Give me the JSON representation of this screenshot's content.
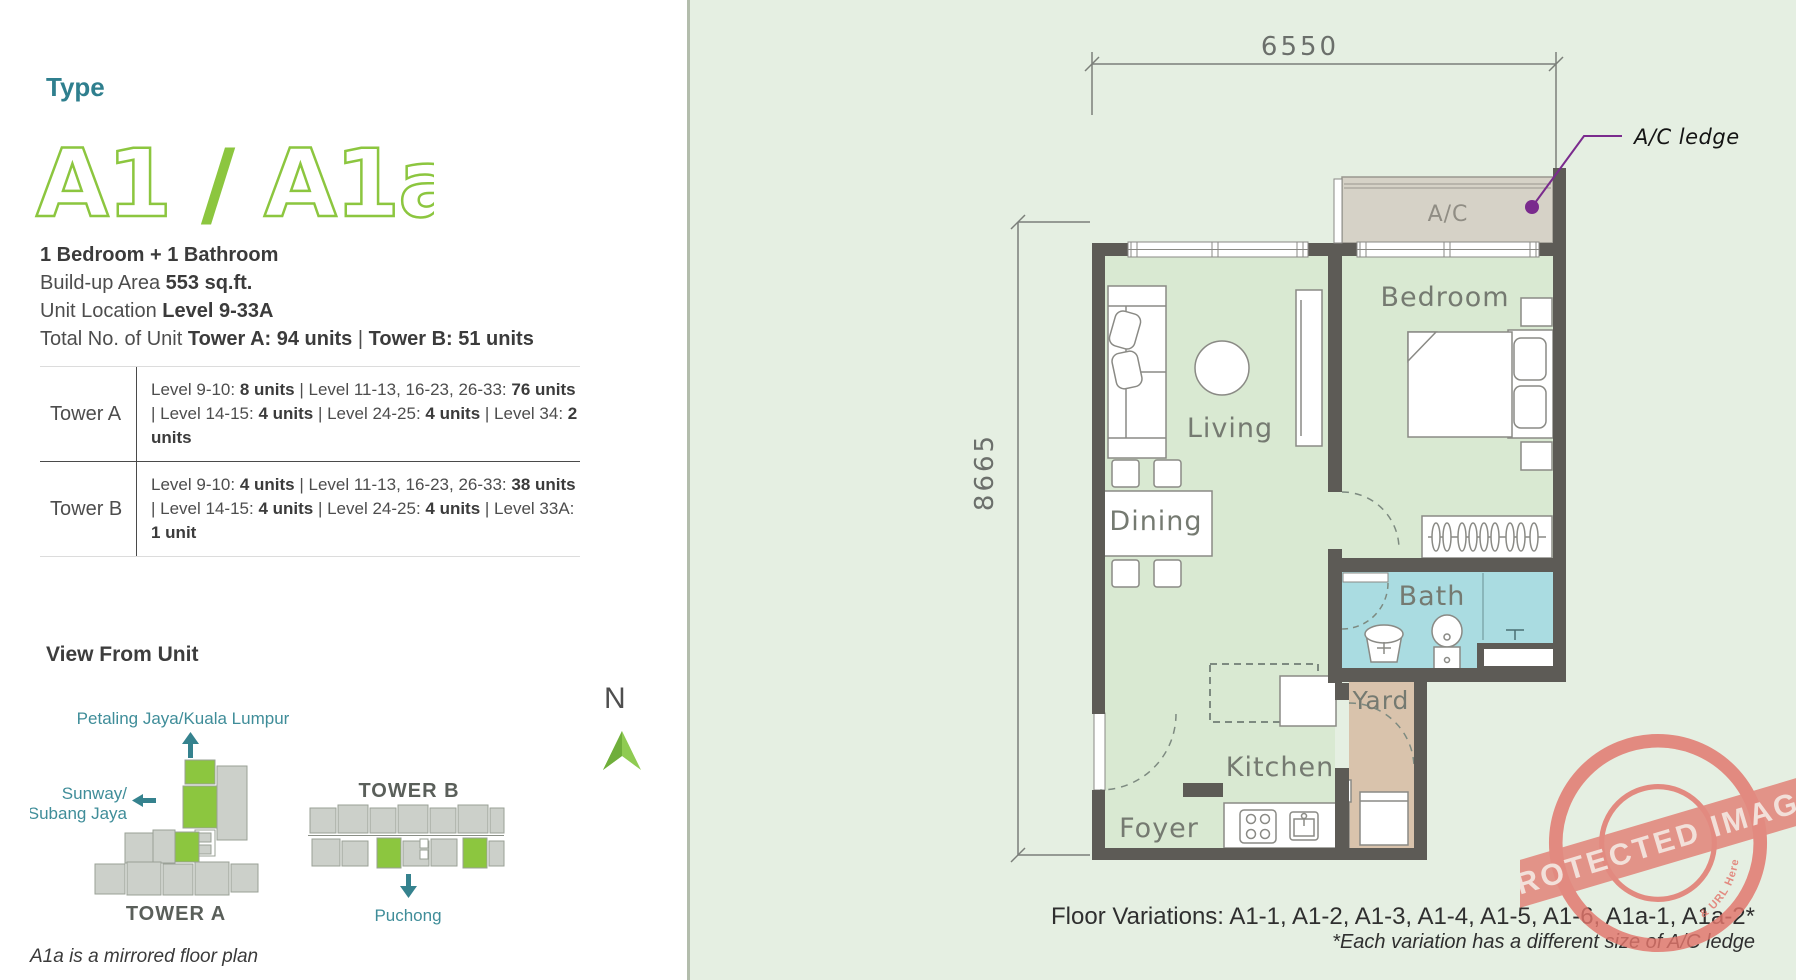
{
  "colors": {
    "accent_teal": "#2f7f8e",
    "brand_green": "#8cc63f",
    "wall_gray": "#5d5b56",
    "panel_green": "#e5efe2",
    "room_green": "#d9e9d2",
    "bath_blue": "#aadce1",
    "yard_tan": "#d9c3ac",
    "ac_gray": "#d6d2c7",
    "annotation_purple": "#7a2b8d",
    "stamp_salmon": "#e2756b"
  },
  "left_panel": {
    "type_label": "Type",
    "unit_code": {
      "part1": "A1",
      "slash": "/",
      "part2": "A1a"
    },
    "specs": [
      {
        "segments": [
          {
            "t": "1 Bedroom + 1 Bathroom",
            "b": true
          }
        ]
      },
      {
        "segments": [
          {
            "t": "Build-up Area "
          },
          {
            "t": "553 sq.ft.",
            "b": true
          }
        ]
      },
      {
        "segments": [
          {
            "t": "Unit Location "
          },
          {
            "t": "Level 9-33A",
            "b": true
          }
        ]
      },
      {
        "segments": [
          {
            "t": "Total No. of Unit "
          },
          {
            "t": "Tower A: 94 units",
            "b": true
          },
          {
            "t": "  |  "
          },
          {
            "t": "Tower B: 51 units",
            "b": true
          }
        ]
      }
    ],
    "unit_table": {
      "rows": [
        {
          "label": "Tower A",
          "segments": [
            {
              "t": "Level 9-10: "
            },
            {
              "t": "8 units",
              "b": true
            },
            {
              "t": "  |  Level 11-13, 16-23, 26-33: "
            },
            {
              "t": "76 units",
              "b": true
            },
            {
              "t": "  |  Level 14-15: "
            },
            {
              "t": "4 units",
              "b": true
            },
            {
              "t": "  |  Level 24-25: "
            },
            {
              "t": "4 units",
              "b": true
            },
            {
              "t": "  |  Level 34: "
            },
            {
              "t": "2 units",
              "b": true
            }
          ]
        },
        {
          "label": "Tower B",
          "segments": [
            {
              "t": "Level 9-10: "
            },
            {
              "t": "4 units",
              "b": true
            },
            {
              "t": "  |  Level 11-13, 16-23, 26-33: "
            },
            {
              "t": "38 units",
              "b": true
            },
            {
              "t": "  |  Level 14-15: "
            },
            {
              "t": "4 units",
              "b": true
            },
            {
              "t": "  |  Level 24-25: "
            },
            {
              "t": "4 units",
              "b": true
            },
            {
              "t": "  |  Level 33A: "
            },
            {
              "t": "1 unit",
              "b": true
            }
          ]
        }
      ]
    },
    "view_from_unit": {
      "title": "View From Unit",
      "direction_north": "Petaling Jaya/Kuala Lumpur",
      "direction_west_line1": "Sunway/",
      "direction_west_line2": "Subang Jaya",
      "direction_south": "Puchong",
      "tower_a_label": "TOWER A",
      "tower_b_label": "TOWER B",
      "compass_letter": "N"
    },
    "footnote": "A1a is a mirrored floor plan"
  },
  "floor_plan": {
    "dimensions": {
      "width": "6550",
      "height": "8665"
    },
    "rooms": {
      "ac": "A/C",
      "bedroom": "Bedroom",
      "living": "Living",
      "dining": "Dining",
      "bath": "Bath",
      "yard": "Yard",
      "kitchen": "Kitchen",
      "foyer": "Foyer"
    },
    "annotation": {
      "ac_ledge": "A/C ledge"
    },
    "floor_variations": "Floor Variations: A1-1, A1-2, A1-3, A1-4, A1-5, A1-6, A1a-1, A1a-2*",
    "variation_note": "*Each variation has a different size of A/C ledge"
  },
  "watermark": {
    "top_arc": "WP CONTENT COPY PROTECTION PLUGIN",
    "bottom_arc": "& URL Here",
    "banner": "PROTECTED IMAGE"
  }
}
